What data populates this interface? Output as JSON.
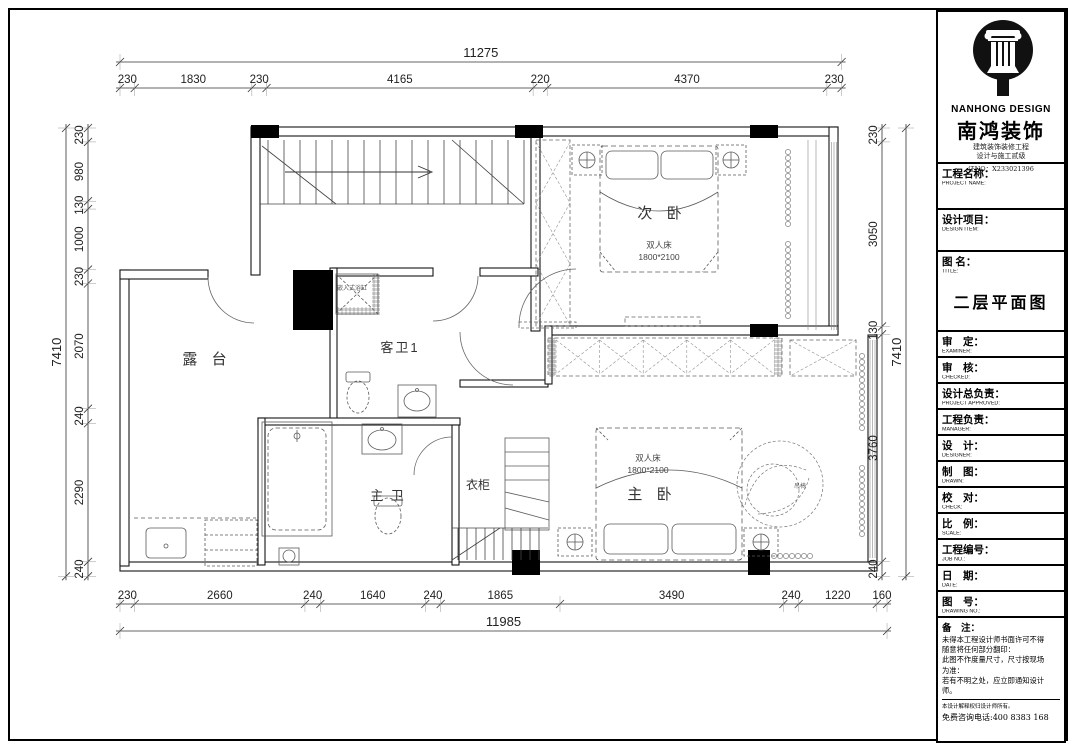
{
  "title_block": {
    "brand_en": "NANHONG DESIGN",
    "brand_cn": "南鸿装饰",
    "cert_line1": "建筑装饰装修工程",
    "cert_line2": "设计与施工贰级",
    "cert_no": "证NO：X233021396",
    "fields": [
      {
        "cn": "工程名称：",
        "en": "PROJECT NAME:"
      },
      {
        "cn": "设计项目：",
        "en": "DESIGN ITEM:"
      },
      {
        "cn": "图 名：",
        "en": "TITLE:"
      },
      {
        "cn": "审　定：",
        "en": "EXAMINER:"
      },
      {
        "cn": "审　核：",
        "en": "CHECKED:"
      },
      {
        "cn": "设计总负责：",
        "en": "PROJECT APPROVED:"
      },
      {
        "cn": "工程负责：",
        "en": "MANAGER:"
      },
      {
        "cn": "设　计：",
        "en": "DESIGNER:"
      },
      {
        "cn": "制　图：",
        "en": "DRAWN:"
      },
      {
        "cn": "校　对：",
        "en": "CHECK:"
      },
      {
        "cn": "比　例：",
        "en": "SCALE:"
      },
      {
        "cn": "工程编号：",
        "en": "JOB NO.:"
      },
      {
        "cn": "日　期：",
        "en": "DATE:"
      },
      {
        "cn": "图　号：",
        "en": "DRAWING NO.:"
      }
    ],
    "drawing_title": "二层平面图",
    "notes_label": "备　注：",
    "notes": [
      "未得本工程设计师书面许可不得",
      "随意将任何部分翻印：",
      "此图不作度量尺寸，尺寸按现场",
      "为准：",
      "若有不明之处，应立即通知设计",
      "师。"
    ],
    "fine_print": "本设计解释权归设计师所有。",
    "hotline": "免费咨询电话:400 8383 168"
  },
  "plan": {
    "rooms": {
      "bedroom2": "次 卧",
      "terrace": "露 台",
      "guest_bath": "客卫1",
      "master_bath": "主 卫",
      "wardrobe": "衣柜",
      "master_bedroom": "主 卧"
    },
    "labels": {
      "double_bed": "双人床",
      "bed_size": "1800*2100",
      "built_in_tub": "嵌入式浴缸",
      "hanging_chair": "吊椅"
    },
    "dims": {
      "top_total": "11275",
      "top": [
        "230",
        "1830",
        "230",
        "4165",
        "220",
        "4370",
        "230"
      ],
      "bottom": [
        "230",
        "2660",
        "240",
        "1640",
        "240",
        "1865",
        "3490",
        "240",
        "1220",
        "160"
      ],
      "bottom_total": "11985",
      "left": [
        "230",
        "980",
        "130",
        "1000",
        "230",
        "2070",
        "240",
        "2290",
        "240"
      ],
      "left_total": "7410",
      "right": [
        "230",
        "3050",
        "130",
        "3760",
        "240"
      ],
      "right_total": "7410"
    }
  }
}
